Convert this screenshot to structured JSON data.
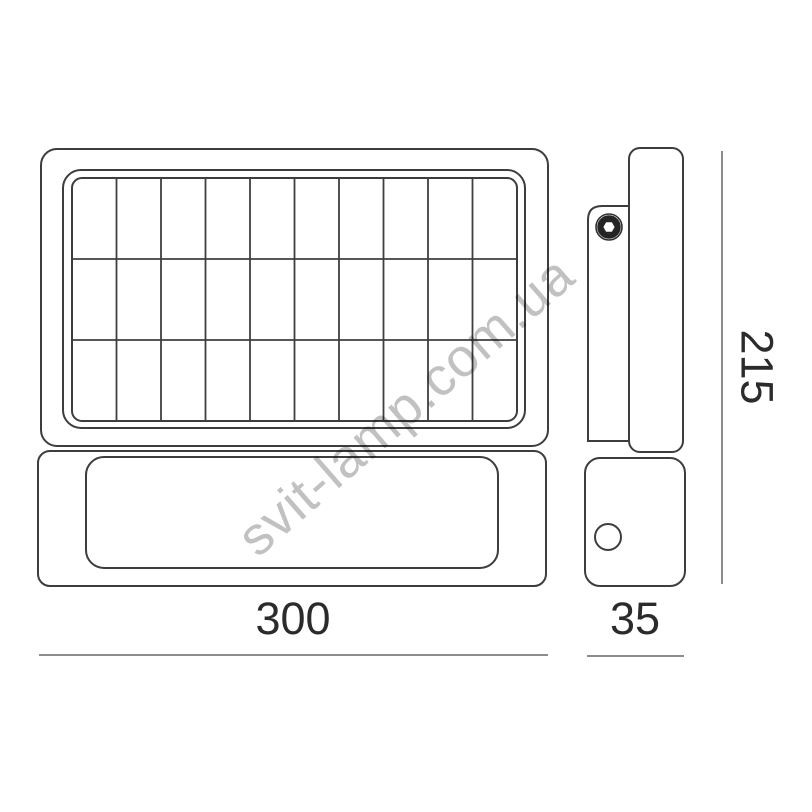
{
  "watermark": {
    "text": "svit-lamp.com.ua",
    "color": "#c1c1c1"
  },
  "front_view": {
    "solar_grid": {
      "columns": 10,
      "rows": 3
    }
  },
  "side_view": {
    "icons": {
      "bolt": "hex-bolt-in-circle",
      "sensor": "circle-hole"
    }
  },
  "dimensions": {
    "front_width": "300",
    "side_width": "35",
    "height": "215"
  },
  "colors": {
    "outline": "#3d3d3d",
    "dimension_line": "#8c8c8c",
    "dimension_text": "#2b2b2b",
    "watermark": "#c1c1c1",
    "background": "#ffffff"
  }
}
